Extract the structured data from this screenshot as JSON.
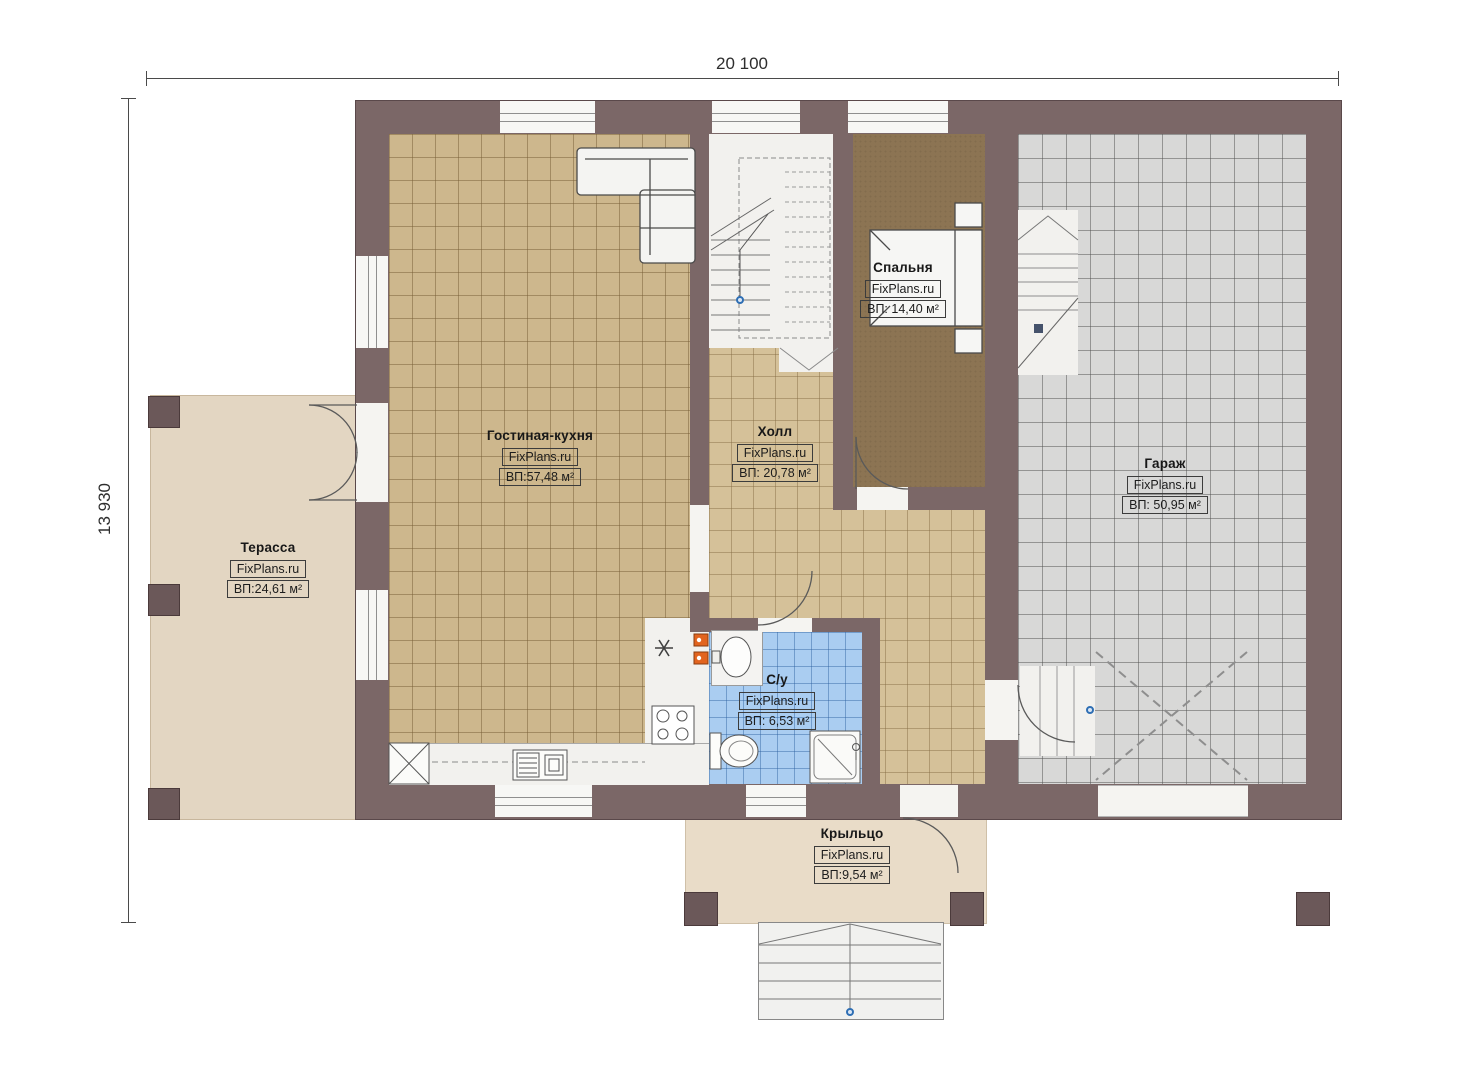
{
  "dimensions": {
    "width_label": "20 100",
    "height_label": "13 930"
  },
  "rooms": [
    {
      "id": "terrace",
      "name": "Терасса",
      "watermark": "FixPlans.ru",
      "area": "ВП:24,61 м²"
    },
    {
      "id": "living",
      "name": "Гостиная-кухня",
      "watermark": "FixPlans.ru",
      "area": "ВП:57,48 м²"
    },
    {
      "id": "hall",
      "name": "Холл",
      "watermark": "FixPlans.ru",
      "area": "ВП: 20,78 м²"
    },
    {
      "id": "bedroom",
      "name": "Спальня",
      "watermark": "FixPlans.ru",
      "area": "ВП: 14,40 м²"
    },
    {
      "id": "garage",
      "name": "Гараж",
      "watermark": "FixPlans.ru",
      "area": "ВП: 50,95 м²"
    },
    {
      "id": "bathroom",
      "name": "С/у",
      "watermark": "FixPlans.ru",
      "area": "ВП: 6,53 м²"
    },
    {
      "id": "porch",
      "name": "Крыльцо",
      "watermark": "FixPlans.ru",
      "area": "ВП:9,54 м²"
    }
  ],
  "colors": {
    "wall": "#7b6767",
    "living_tile": "#cdb78d",
    "hall_tile": "#d5c199",
    "bedroom_carpet": "#8c7453",
    "garage_tile": "#d8d8d7",
    "bathroom_tile": "#aacdf1",
    "terrace_floor": "#e3d6c2",
    "porch_floor": "#e9dcc8",
    "appliance_orange": "#e2641f",
    "marker_blue": "#2f6fb4"
  }
}
